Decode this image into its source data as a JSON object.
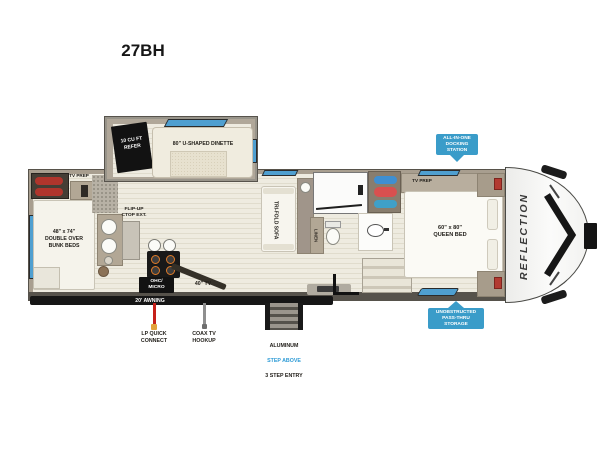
{
  "title": "27BH",
  "colors": {
    "badge_blue": "#3a9cc9",
    "window_blue": "#4f9fd0",
    "lp_red": "#c6201a",
    "coax_gray": "#8f8f8f",
    "step_above_blue": "#2e9bd6",
    "wall_tan": "#a89e8f",
    "floor_cream": "#eeebe0"
  },
  "floorplan": {
    "brand": "REFLECTION",
    "refer": "10 CU FT\nREFER",
    "dinette": "80\" U-SHAPED DINETTE",
    "tv_prep_rear": "TV PREP",
    "bunk_beds": "48\" x 74\"\nDOUBLE OVER\nBUNK BEDS",
    "flip_up": "FLIP-UP\nCTOP EXT.",
    "tri_fold_sofa": "TRI-FOLD SOFA",
    "linen": "LINEN",
    "ohc_micro": "OHC/\nMICRO",
    "tv_40": "40\" TV",
    "tv_prep_bedroom": "TV PREP",
    "queen_bed": "60\" x 80\"\nQUEEN BED"
  },
  "callouts": {
    "docking_station": "ALL-IN-ONE\nDOCKING\nSTATION",
    "pass_thru_storage": "UNOBSTRUCTED\nPASS-THRU\nSTORAGE",
    "awning": "20' AWNING",
    "lp_quick_connect": "LP QUICK\nCONNECT",
    "coax_tv_hookup": "COAX TV\nHOOKUP",
    "entry_step_line1": "ALUMINUM",
    "entry_step_line2": "STEP ABOVE",
    "entry_step_line3": "3 STEP ENTRY"
  }
}
